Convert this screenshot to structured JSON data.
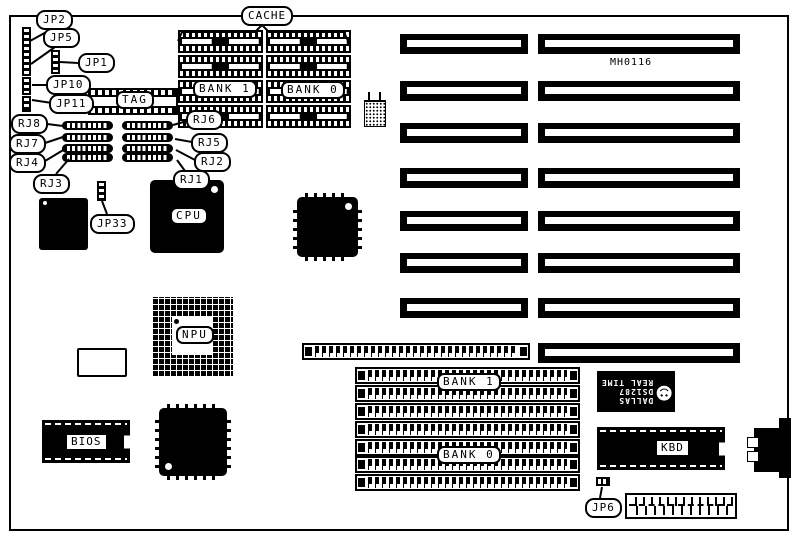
{
  "board": {
    "code": "MH0116",
    "colors": {
      "ink": "#000000",
      "paper": "#ffffff"
    }
  },
  "callouts": {
    "jp2": "JP2",
    "jp5": "JP5",
    "jp1": "JP1",
    "jp10": "JP10",
    "jp11": "JP11",
    "jp33": "JP33",
    "jp6": "JP6",
    "rj8": "RJ8",
    "rj7": "RJ7",
    "rj4": "RJ4",
    "rj3": "RJ3",
    "rj6": "RJ6",
    "rj5": "RJ5",
    "rj2": "RJ2",
    "rj1": "RJ1",
    "cache": "CACHE"
  },
  "chips": {
    "tag": "TAG",
    "cache_bank1": "BANK 1",
    "cache_bank0": "BANK 0",
    "cpu": "CPU",
    "npu": "NPU",
    "bios": "BIOS",
    "kbd": "KBD",
    "simm_bank1": "BANK 1",
    "simm_bank0": "BANK 0"
  },
  "rtc_chip": {
    "brand": "DALLAS",
    "part": "DS1287",
    "function": "REAL TIME",
    "logo_icon": "dallas-devil-face",
    "logo_glyph": "☻"
  },
  "structure": {
    "isa_slot_rows": 8,
    "isa_rows_with_short_segment": 7,
    "cache_banks": 2,
    "cache_chips_per_bank": 4,
    "simm_sockets_total": 8,
    "simm_sockets_in_group": 7,
    "rj_pin_rows_left": 4,
    "rj_pin_rows_right": 4
  }
}
